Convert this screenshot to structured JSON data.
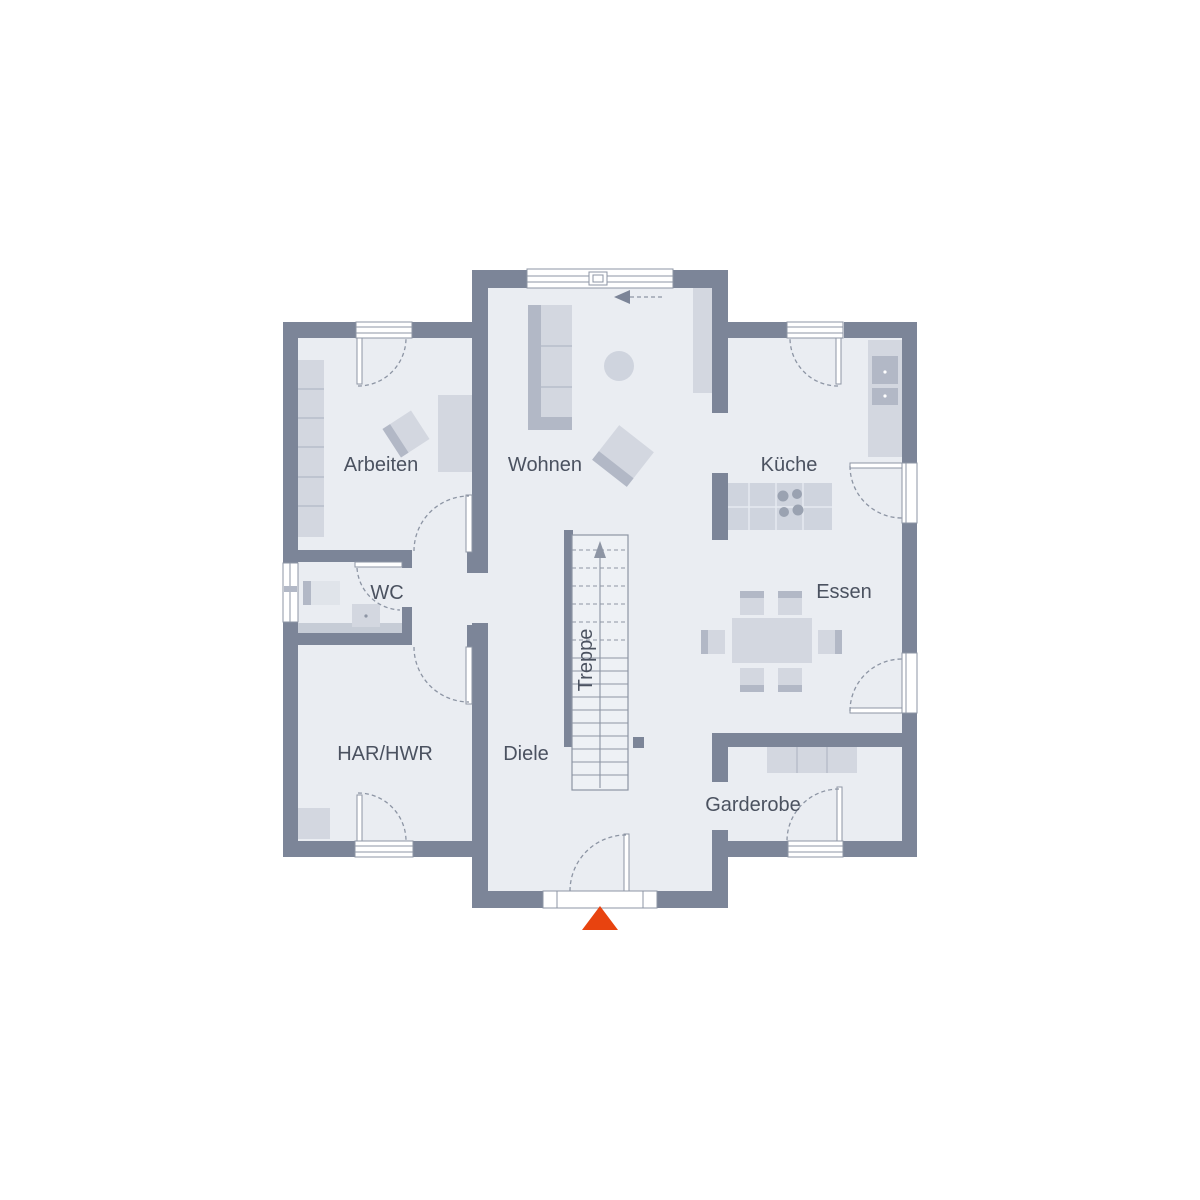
{
  "floorplan": {
    "rooms": {
      "arbeiten": "Arbeiten",
      "wohnen": "Wohnen",
      "kueche": "Küche",
      "wc": "WC",
      "essen": "Essen",
      "har_hwr": "HAR/HWR",
      "diele": "Diele",
      "treppe": "Treppe",
      "garderobe": "Garderobe"
    },
    "colors": {
      "background": "#ffffff",
      "wall": "#7c8598",
      "floor": "#eaedf2",
      "line": "#8d95a4",
      "text": "#4b5260",
      "furniture": "#d3d7e0",
      "furniture_mid": "#cfd4de",
      "furniture_dark": "#b2b8c6",
      "fixture_light": "#e0e4ea",
      "fixture_strip": "#c6ccd6",
      "stair": "#eef1f5",
      "burner": "#9aa2b1",
      "entrance_marker": "#e8430f"
    }
  }
}
